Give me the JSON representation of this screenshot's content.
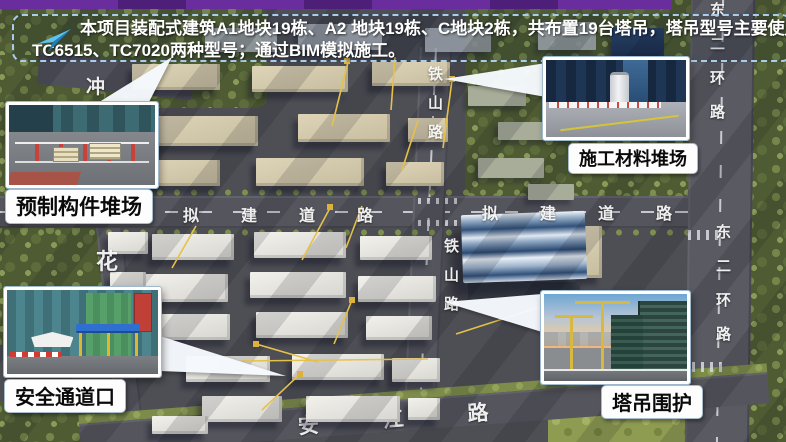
{
  "slide": {
    "top_bar_color": "#6a2d9e",
    "banner": {
      "icon": "send-arrow-icon",
      "line1": "本项目装配式建筑A1地块19栋、A2 地块19栋、C地块2栋，共布置19台塔吊，塔吊型号主要使用",
      "line2": "TC6515、TC7020两种型号；通过BIM模拟施工。",
      "border_color": "#a9cdec",
      "text_color": "#ffffff"
    }
  },
  "callouts": [
    {
      "id": "precast-component-yard",
      "label": "预制构件堆场"
    },
    {
      "id": "construction-material-yard",
      "label": "施工材料堆场"
    },
    {
      "id": "safety-passage-entrance",
      "label": "安全通道口"
    },
    {
      "id": "tower-crane-enclosure",
      "label": "塔吊围护"
    }
  ],
  "map": {
    "road_names": {
      "east_second_ring": "东二环路",
      "tieshan": "铁山路",
      "proposed": "拟建道路",
      "anjiang": "安江路",
      "hua": "花",
      "chong": "冲"
    },
    "colors": {
      "road": "#56565e",
      "trees": "#4f5c33",
      "crane_line": "#e6c14a",
      "building_white": "#efeeea",
      "building_beige": "#d6cbae",
      "big_building_blue": "#31517a"
    }
  }
}
